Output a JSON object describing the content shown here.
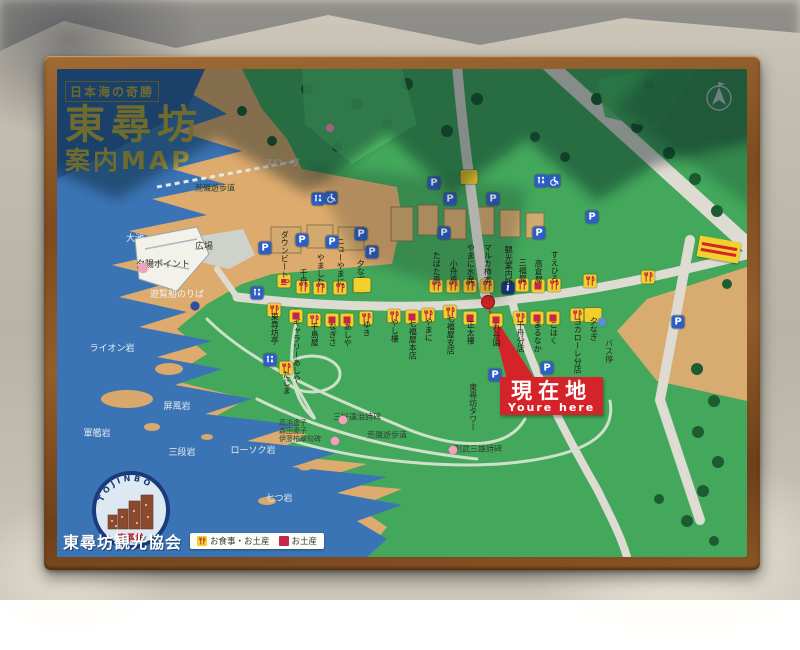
{
  "colors": {
    "sea": "#3b74b4",
    "sea_deep": "#2e5f9e",
    "land": "#43a85c",
    "land_shadow": "#1e5c33",
    "coast": "#ddab6e",
    "road": "#dedcd2",
    "marker_yellow": "#f2cf2a",
    "marker_red": "#c4274b",
    "parking_blue": "#2b5fc7",
    "info_blue": "#17347d",
    "pink": "#f2a0bc",
    "red": "#d5232a",
    "title_gold": "#b9a53b",
    "frame_wood": "#7d4b1f",
    "wall": "#bfb9ac"
  },
  "title": {
    "tagline": "日本海の奇勝",
    "main": "東尋坊",
    "sub": "案内MAP"
  },
  "you_are_here": {
    "line1": "現在地",
    "line2": "Youre here"
  },
  "footer": {
    "org": "東尋坊観光協会",
    "legend": [
      {
        "type": "meal",
        "label": "お食事・お土産"
      },
      {
        "type": "souvenir",
        "label": "お土産"
      }
    ]
  },
  "badge": {
    "arc_text": "TOJINBO",
    "name": "東尋坊"
  },
  "map": {
    "area_labels": [
      {
        "text": "大池",
        "x": 78,
        "y": 170,
        "color": "#eef2f4",
        "size": 9
      },
      {
        "text": "広場",
        "x": 147,
        "y": 178,
        "color": "#3a3a2c",
        "size": 9
      },
      {
        "text": "スロープ",
        "x": 225,
        "y": 95,
        "color": "#e4e0cc",
        "size": 9
      },
      {
        "text": "荒磯遊歩道",
        "x": 158,
        "y": 119,
        "color": "#2e3a24",
        "size": 8
      },
      {
        "text": "夕陽ポイント",
        "x": 106,
        "y": 196,
        "color": "#3a3226",
        "size": 9
      },
      {
        "text": "遊覧船のりば",
        "x": 120,
        "y": 226,
        "color": "#eef2f4",
        "size": 9
      },
      {
        "text": "ライオン岩",
        "x": 55,
        "y": 280,
        "color": "#eef2f4",
        "size": 9
      },
      {
        "text": "屏風岩",
        "x": 120,
        "y": 338,
        "color": "#e6ecf2",
        "size": 9
      },
      {
        "text": "軍艦岩",
        "x": 40,
        "y": 365,
        "color": "#e6ecf2",
        "size": 9
      },
      {
        "text": "三段岩",
        "x": 125,
        "y": 384,
        "color": "#e6ecf2",
        "size": 9
      },
      {
        "text": "ローソク岩",
        "x": 196,
        "y": 382,
        "color": "#e6ecf2",
        "size": 9
      },
      {
        "text": "七つ岩",
        "x": 222,
        "y": 430,
        "color": "#e6ecf2",
        "size": 9
      },
      {
        "text": "三好達治詩碑",
        "x": 300,
        "y": 348,
        "color": "#33402c",
        "size": 8
      },
      {
        "text": "高浜虚子\n森田愛子\n伊藤柏翠句碑",
        "x": 243,
        "y": 362,
        "color": "#33402c",
        "size": 7
      },
      {
        "text": "則武三雄詩碑",
        "x": 421,
        "y": 380,
        "color": "#33402c",
        "size": 8
      },
      {
        "text": "荒磯遊歩道",
        "x": 330,
        "y": 366,
        "color": "#33402c",
        "size": 8
      },
      {
        "text": "東尋坊タワー",
        "x": 416,
        "y": 314,
        "color": "#2c2c1e",
        "size": 8,
        "vertical": true
      },
      {
        "text": "バス停",
        "x": 552,
        "y": 270,
        "color": "#2c2c1e",
        "size": 8,
        "vertical": true
      }
    ],
    "poi_dots": [
      {
        "x": 86,
        "y": 199,
        "color": "#f2a0bc",
        "d": 10
      },
      {
        "x": 273,
        "y": 59,
        "color": "#f2a0bc",
        "d": 9
      },
      {
        "x": 286,
        "y": 351,
        "color": "#f2a0bc",
        "d": 9
      },
      {
        "x": 278,
        "y": 372,
        "color": "#f2a0bc",
        "d": 9
      },
      {
        "x": 396,
        "y": 381,
        "color": "#f2a0bc",
        "d": 9
      },
      {
        "x": 138,
        "y": 237,
        "color": "#2b4fa0",
        "d": 9
      },
      {
        "x": 545,
        "y": 253,
        "color": "#5a8fd0",
        "d": 9
      }
    ],
    "current_dot": {
      "x": 431,
      "y": 233,
      "color": "#d5232a",
      "d": 12
    },
    "shops": [
      {
        "name": "ダウンビート",
        "x": 227,
        "y": 212,
        "type": "cafe",
        "pos": "above"
      },
      {
        "name": "千舟",
        "x": 246,
        "y": 218,
        "type": "meal",
        "pos": "above"
      },
      {
        "name": "やました",
        "x": 263,
        "y": 219,
        "type": "meal",
        "pos": "above"
      },
      {
        "name": "ニューやまに",
        "x": 283,
        "y": 219,
        "type": "meal",
        "pos": "above"
      },
      {
        "name": "夕なぎ",
        "x": 303,
        "y": 217,
        "type": "meal",
        "pos": "above"
      },
      {
        "name": "たばた亭",
        "x": 379,
        "y": 217,
        "type": "meal",
        "pos": "above"
      },
      {
        "name": "小舟亭",
        "x": 396,
        "y": 217,
        "type": "meal",
        "pos": "above"
      },
      {
        "name": "やまに水産",
        "x": 413,
        "y": 217,
        "type": "meal",
        "pos": "above"
      },
      {
        "name": "マルカ柿本",
        "x": 430,
        "y": 217,
        "type": "meal",
        "pos": "above"
      },
      {
        "name": "三福屋",
        "x": 465,
        "y": 216,
        "type": "meal",
        "pos": "above"
      },
      {
        "name": "高倉屋",
        "x": 481,
        "y": 217,
        "type": "souvenir",
        "pos": "above"
      },
      {
        "name": "すえひろ",
        "x": 497,
        "y": 216,
        "type": "meal",
        "pos": "above"
      },
      {
        "name": "",
        "x": 533,
        "y": 212,
        "type": "meal",
        "pos": "above"
      },
      {
        "name": "",
        "x": 591,
        "y": 208,
        "type": "meal",
        "pos": "above"
      },
      {
        "name": "東尋坊亭",
        "x": 217,
        "y": 241,
        "type": "meal",
        "pos": "below"
      },
      {
        "name": "ギャラリーあしや",
        "x": 239,
        "y": 247,
        "type": "souvenir",
        "pos": "below"
      },
      {
        "name": "千島屋",
        "x": 257,
        "y": 251,
        "type": "meal",
        "pos": "below"
      },
      {
        "name": "なぎさ",
        "x": 275,
        "y": 251,
        "type": "souvenir",
        "pos": "below"
      },
      {
        "name": "あしや",
        "x": 290,
        "y": 251,
        "type": "souvenir",
        "pos": "below"
      },
      {
        "name": "ゆき",
        "x": 309,
        "y": 249,
        "type": "meal",
        "pos": "below"
      },
      {
        "name": "やし樓",
        "x": 337,
        "y": 247,
        "type": "meal",
        "pos": "below"
      },
      {
        "name": "七福屋本店",
        "x": 355,
        "y": 248,
        "type": "souvenir",
        "pos": "below"
      },
      {
        "name": "やまに",
        "x": 371,
        "y": 246,
        "type": "meal",
        "pos": "below"
      },
      {
        "name": "七福屋支店",
        "x": 393,
        "y": 243,
        "type": "meal",
        "pos": "below"
      },
      {
        "name": "正太樓",
        "x": 413,
        "y": 249,
        "type": "souvenir",
        "pos": "below"
      },
      {
        "name": "九谷園",
        "x": 439,
        "y": 251,
        "type": "souvenir",
        "pos": "below"
      },
      {
        "name": "千舟分店",
        "x": 463,
        "y": 249,
        "type": "meal",
        "pos": "below"
      },
      {
        "name": "まるなか",
        "x": 480,
        "y": 249,
        "type": "souvenir",
        "pos": "below"
      },
      {
        "name": "こはく",
        "x": 496,
        "y": 249,
        "type": "souvenir",
        "pos": "below"
      },
      {
        "name": "ヨカローレ分店",
        "x": 520,
        "y": 246,
        "type": "meal",
        "pos": "below"
      },
      {
        "name": "夕なぎ",
        "x": 536,
        "y": 246,
        "type": "building",
        "pos": "below"
      },
      {
        "name": "たじま",
        "x": 229,
        "y": 299,
        "type": "meal",
        "pos": "below"
      }
    ],
    "info_office": {
      "name": "観光案内所",
      "x": 451,
      "y": 219,
      "glyph": "i"
    },
    "parkings": [
      {
        "x": 208,
        "y": 179
      },
      {
        "x": 245,
        "y": 171
      },
      {
        "x": 275,
        "y": 173
      },
      {
        "x": 304,
        "y": 165
      },
      {
        "x": 315,
        "y": 183
      },
      {
        "x": 377,
        "y": 114
      },
      {
        "x": 393,
        "y": 130
      },
      {
        "x": 436,
        "y": 130
      },
      {
        "x": 387,
        "y": 164
      },
      {
        "x": 482,
        "y": 164
      },
      {
        "x": 535,
        "y": 148
      },
      {
        "x": 621,
        "y": 253
      },
      {
        "x": 438,
        "y": 306
      },
      {
        "x": 490,
        "y": 299
      }
    ],
    "parking_glyph": "P",
    "toilets": [
      {
        "x": 261,
        "y": 130,
        "type": "toilet"
      },
      {
        "x": 274,
        "y": 129,
        "type": "wheelchair"
      },
      {
        "x": 484,
        "y": 112,
        "type": "toilet"
      },
      {
        "x": 497,
        "y": 112,
        "type": "wheelchair"
      },
      {
        "x": 213,
        "y": 291,
        "type": "toilet"
      },
      {
        "x": 200,
        "y": 224,
        "type": "toilet"
      }
    ],
    "buildings": [
      {
        "x": 412,
        "y": 108
      },
      {
        "x": 305,
        "y": 216
      }
    ]
  }
}
